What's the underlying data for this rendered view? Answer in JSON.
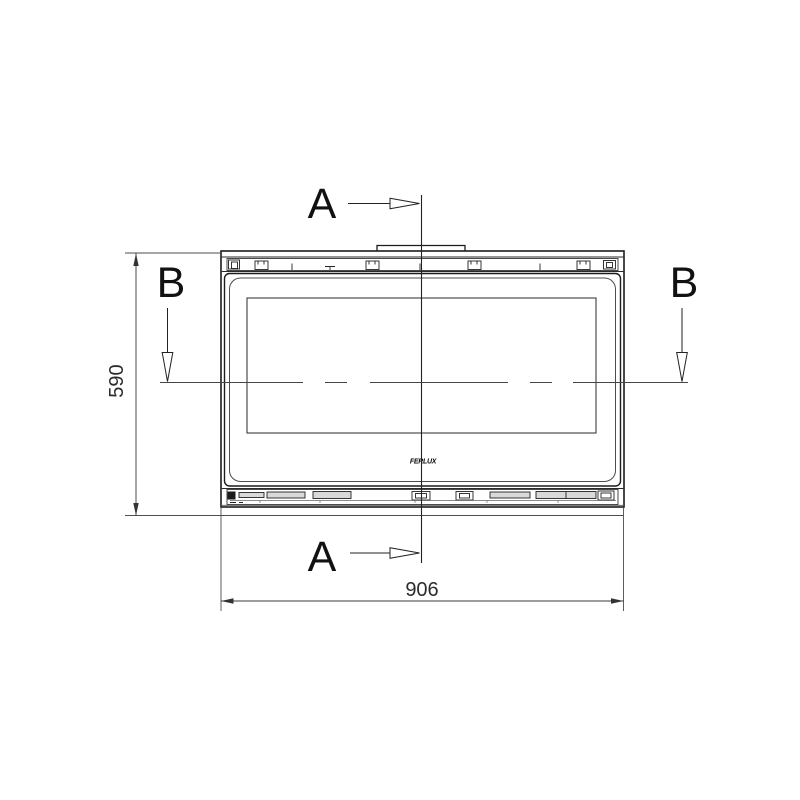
{
  "drawing": {
    "type_label": "technical-drawing",
    "section_marks": {
      "a_top": "A",
      "a_bottom": "A",
      "b_left": "B",
      "b_right": "B"
    },
    "dimensions": {
      "width_mm": "906",
      "height_mm": "590"
    },
    "logo_text": "FERLUX",
    "colors": {
      "background": "#ffffff",
      "main_line": "#1c1c1c",
      "thin_line": "#4d4d4d",
      "dimension_line": "#3a3a3a",
      "slot_fill": "#d9d9d9"
    }
  }
}
